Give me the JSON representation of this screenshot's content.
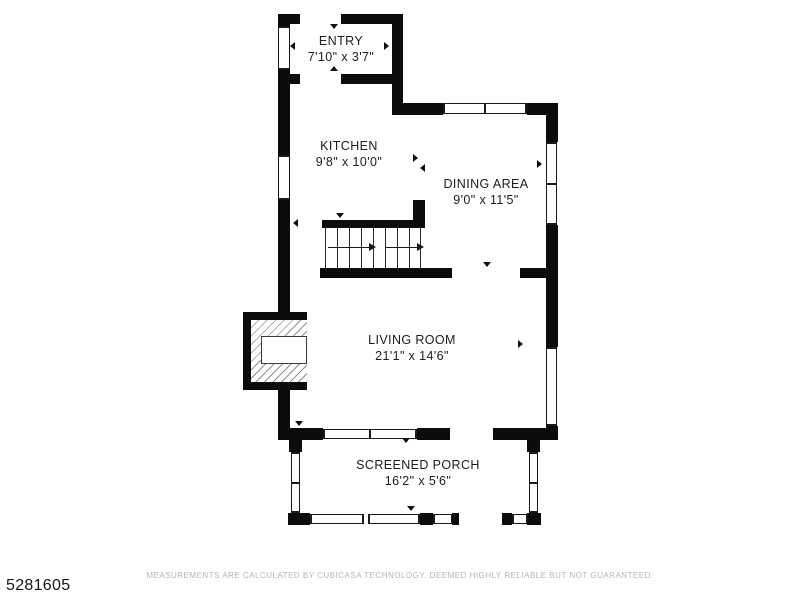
{
  "floorplan": {
    "rooms": {
      "entry": {
        "name": "ENTRY",
        "dims": "7'10\" x 3'7\""
      },
      "kitchen": {
        "name": "KITCHEN",
        "dims": "9'8\" x 10'0\""
      },
      "dining": {
        "name": "DINING AREA",
        "dims": "9'0\" x 11'5\""
      },
      "living": {
        "name": "LIVING ROOM",
        "dims": "21'1\" x 14'6\""
      },
      "porch": {
        "name": "SCREENED PORCH",
        "dims": "16'2\" x 5'6\""
      }
    },
    "features": [
      "staircase",
      "fireplace"
    ],
    "colors": {
      "wall": "#0c0c0c",
      "label": "#1c1c1c",
      "disclaimer": "#b5b5b5",
      "background": "#ffffff"
    }
  },
  "footer": {
    "listing_id": "5281605",
    "disclaimer": "MEASUREMENTS ARE CALCULATED BY CUBICASA TECHNOLOGY. DEEMED HIGHLY RELIABLE BUT NOT GUARANTEED."
  }
}
